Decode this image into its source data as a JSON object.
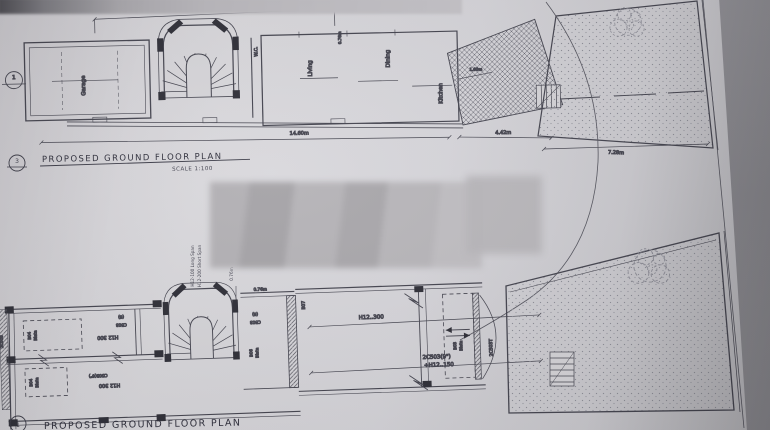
{
  "titles": {
    "top": {
      "marker": "3",
      "text": "PROPOSED GROUND FLOOR PLAN",
      "scale": "SCALE 1:100"
    },
    "bottom": {
      "marker": "1",
      "text": "PROPOSED GROUND FLOOR PLAN"
    }
  },
  "top_plan": {
    "section_marker": "1",
    "rooms": {
      "garage": "Garage",
      "wc": "W.C.",
      "living": "Living",
      "dining": "Dining",
      "kitchen": "Kitchen"
    },
    "dims": {
      "stair": "4.56m",
      "side": "0.76m",
      "length": "14.60m",
      "rear": "4.42m",
      "garden": "7.28m",
      "strip": "1.60m"
    }
  },
  "bottom_plan": {
    "notes": {
      "rebar1": "H12-100 Long Span",
      "rebar2": "H12-200 Short Span"
    },
    "dims": {
      "v": "0.76m",
      "h": "0.76m"
    },
    "labels": {
      "b04a": "B04",
      "b04a2": "Blata",
      "b04b": "B04",
      "b04b2": "Blata",
      "h12a": "H12 300",
      "h12b": "H12 300",
      "c503a": "C503",
      "c503a6": "(6)",
      "c503b": "C503(6\")",
      "c503c": "C503",
      "c503c6": "(6)",
      "edge": "2C503",
      "b06": "B06",
      "b062": "Blata",
      "b07": "B07",
      "mesh": "H12..300",
      "beam": "2C503(9\")",
      "beam2": "+H12..150",
      "b03": "B03",
      "b032": "Blata",
      "right": "2C503T"
    }
  }
}
